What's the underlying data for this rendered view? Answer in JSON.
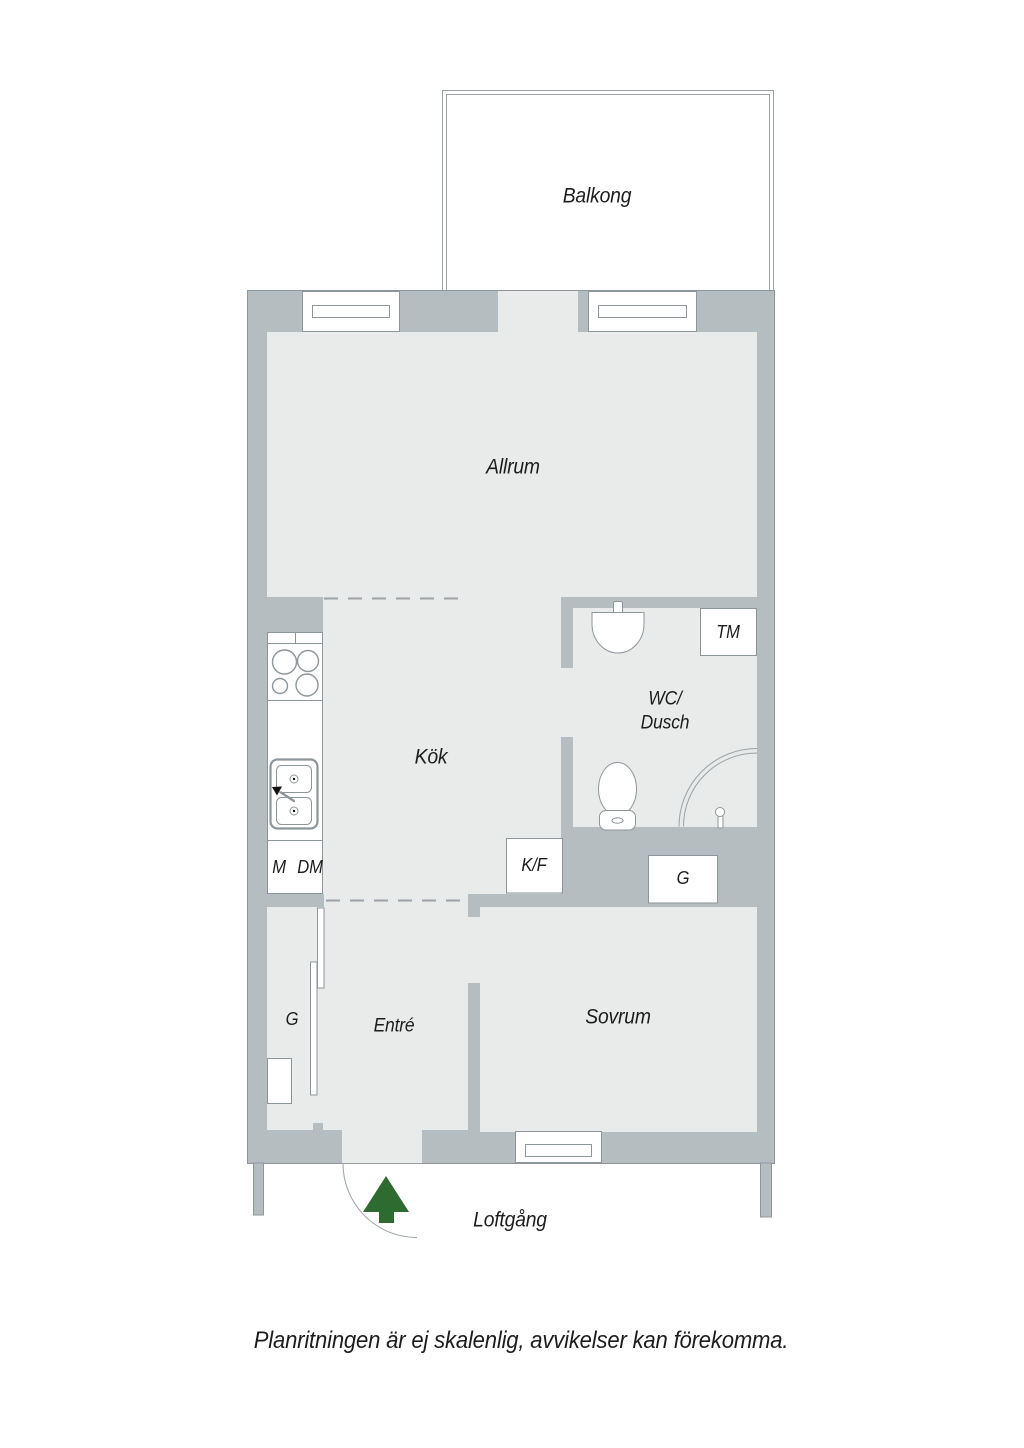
{
  "labels": {
    "balcony": "Balkong",
    "living_room": "Allrum",
    "kitchen": "Kök",
    "bathroom_line1": "WC/",
    "bathroom_line2": "Dusch",
    "washing_machine": "TM",
    "microwave": "M",
    "dishwasher": "DM",
    "fridge_freezer": "K/F",
    "wardrobe_bedroom": "G",
    "wardrobe_hall": "G",
    "hall": "Entré",
    "bedroom": "Sovrum",
    "walkway": "Loftgång",
    "disclaimer": "Planritningen är ej skalenlig, avvikelser kan förekomma."
  },
  "colors": {
    "wall": "#b6bdc1",
    "floor": "#e9eaea",
    "outline": "#8d969a",
    "dash": "#9aa2a6",
    "entrance_arrow": "#2e6b31",
    "text": "#1d1d1d",
    "background": "#ffffff"
  }
}
